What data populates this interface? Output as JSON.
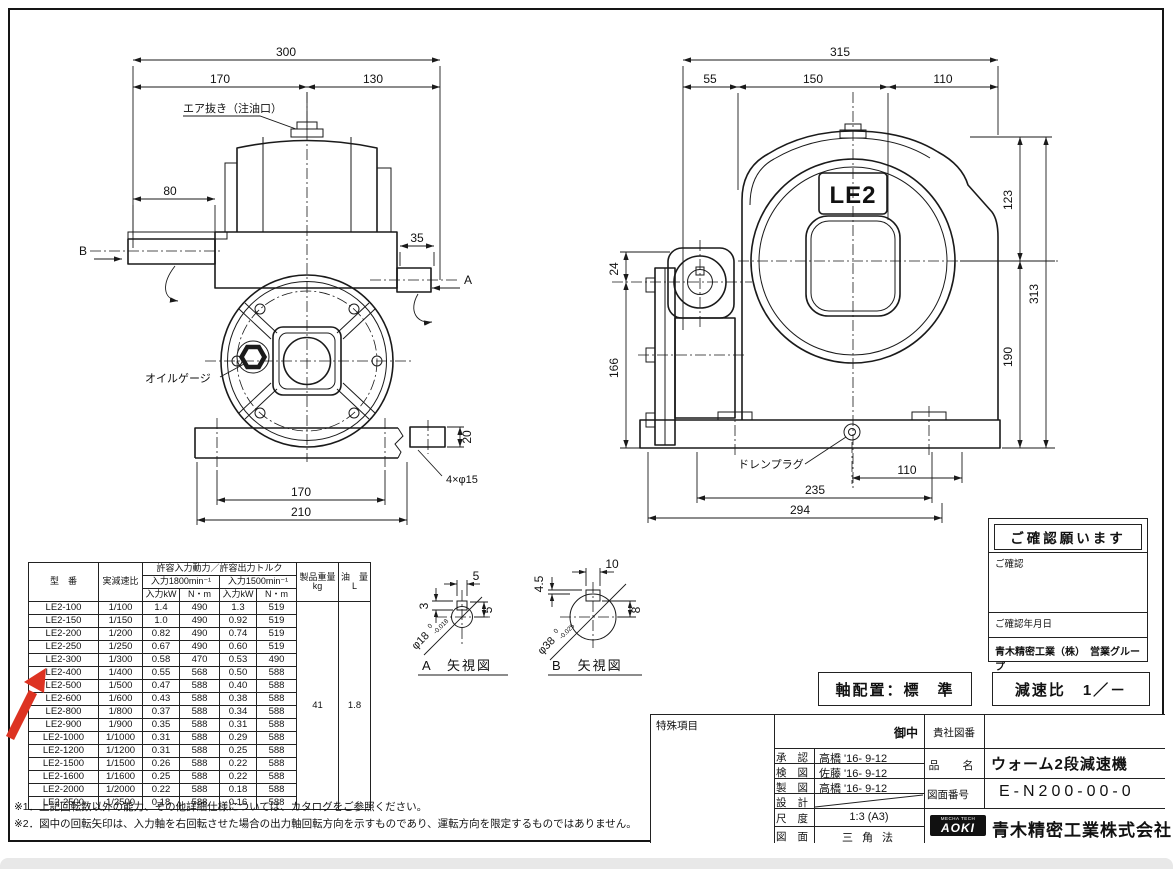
{
  "palette": {
    "line": "#1a1a1a",
    "red": "#dd3322",
    "gray_bar": "#e8e8e8"
  },
  "front_view": {
    "dim_overall": "300",
    "dim_left": "170",
    "dim_right": "130",
    "air_vent_label": "エア抜き（注油口）",
    "dim_shaft": "80",
    "dim_output": "35",
    "view_b": "B",
    "view_a": "A",
    "oil_gauge_label": "オイルゲージ",
    "dim_base_holes": "170",
    "dim_base": "210",
    "holes_note": "4×φ15",
    "dim_flange_t": "20"
  },
  "side_view": {
    "dim_overall": "315",
    "dim_seg1": "55",
    "dim_seg2": "150",
    "dim_seg3": "110",
    "logo": "LE2",
    "dim_offset": "24",
    "dim_height_lower": "166",
    "dim_top_right": "123",
    "dim_total_height": "313",
    "dim_lower_right": "190",
    "drain_label": "ドレンプラグ",
    "dim_drain": "110",
    "dim_bolt_span": "235",
    "dim_base_len": "294"
  },
  "detail_a": {
    "title": "A　矢視図",
    "dim_top": "5",
    "dim_side": "3",
    "dim_right": "5",
    "dia": "φ18",
    "tol_hi": "0",
    "tol_lo": "-0.018"
  },
  "detail_b": {
    "title": "B　矢視図",
    "dim_top": "10",
    "dim_side": "4.5",
    "dim_right": "8",
    "dia": "φ38",
    "tol_hi": "0",
    "tol_lo": "-0.025"
  },
  "spec_table": {
    "h_model": "型　番",
    "h_ratio": "実減速比",
    "h_group": "許容入力動力／許容出力トルク",
    "h_1800": "入力1800min⁻¹",
    "h_1500": "入力1500min⁻¹",
    "h_kw": "入力kW",
    "h_nm": "N・m",
    "h_weight": "製品重量",
    "h_weight_unit": "kg",
    "h_oil": "油　量",
    "h_oil_unit": "L",
    "weight": "41",
    "oil": "1.8",
    "rows": [
      [
        "LE2-100",
        "1/100",
        "1.4",
        "490",
        "1.3",
        "519"
      ],
      [
        "LE2-150",
        "1/150",
        "1.0",
        "490",
        "0.92",
        "519"
      ],
      [
        "LE2-200",
        "1/200",
        "0.82",
        "490",
        "0.74",
        "519"
      ],
      [
        "LE2-250",
        "1/250",
        "0.67",
        "490",
        "0.60",
        "519"
      ],
      [
        "LE2-300",
        "1/300",
        "0.58",
        "470",
        "0.53",
        "490"
      ],
      [
        "LE2-400",
        "1/400",
        "0.55",
        "568",
        "0.50",
        "588"
      ],
      [
        "LE2-500",
        "1/500",
        "0.47",
        "588",
        "0.40",
        "588"
      ],
      [
        "LE2-600",
        "1/600",
        "0.43",
        "588",
        "0.38",
        "588"
      ],
      [
        "LE2-800",
        "1/800",
        "0.37",
        "588",
        "0.34",
        "588"
      ],
      [
        "LE2-900",
        "1/900",
        "0.35",
        "588",
        "0.31",
        "588"
      ],
      [
        "LE2-1000",
        "1/1000",
        "0.31",
        "588",
        "0.29",
        "588"
      ],
      [
        "LE2-1200",
        "1/1200",
        "0.31",
        "588",
        "0.25",
        "588"
      ],
      [
        "LE2-1500",
        "1/1500",
        "0.26",
        "588",
        "0.22",
        "588"
      ],
      [
        "LE2-1600",
        "1/1600",
        "0.25",
        "588",
        "0.22",
        "588"
      ],
      [
        "LE2-2000",
        "1/2000",
        "0.22",
        "588",
        "0.18",
        "588"
      ],
      [
        "LE2-2500",
        "1/2500",
        "0.18",
        "588",
        "0.16",
        "588"
      ]
    ]
  },
  "notes": [
    "※1．上記回転数以外の能力、その他詳細仕様については、カタログをご参照ください。",
    "※2．図中の回転矢印は、入力軸を右回転させた場合の出力軸回転方向を示すものであり、運転方向を限定するものではありません。"
  ],
  "confirm_box": {
    "title": "ご確認願います",
    "sec1": "ご確認",
    "sec2": "ご確認年月日",
    "footer": "青木精密工業（株）　営業グループ"
  },
  "config": {
    "shaft": "軸配置：標　準",
    "ratio": "減速比　1／－"
  },
  "title_block": {
    "special": "特殊項目",
    "recipient": "御中",
    "company_no": "貴社図番",
    "rows": [
      {
        "label": "承 認",
        "value": "高橋 '16- 9-12"
      },
      {
        "label": "検 図",
        "value": "佐藤 '16- 9-12"
      },
      {
        "label": "製 図",
        "value": "高橋 '16- 9-12"
      },
      {
        "label": "設 計",
        "value": ""
      }
    ],
    "scale_label": "尺 度",
    "scale": "1:3 (A3)",
    "method_label": "図 面",
    "method": "三 角 法",
    "name_label": "品　名",
    "name": "ウォーム2段減速機",
    "dwg_label": "図面番号",
    "dwg_no": "E-N200-00-0",
    "logo_small": "MECHA TECH",
    "logo_main": "AOKI",
    "company": "青木精密工業株式会社"
  }
}
